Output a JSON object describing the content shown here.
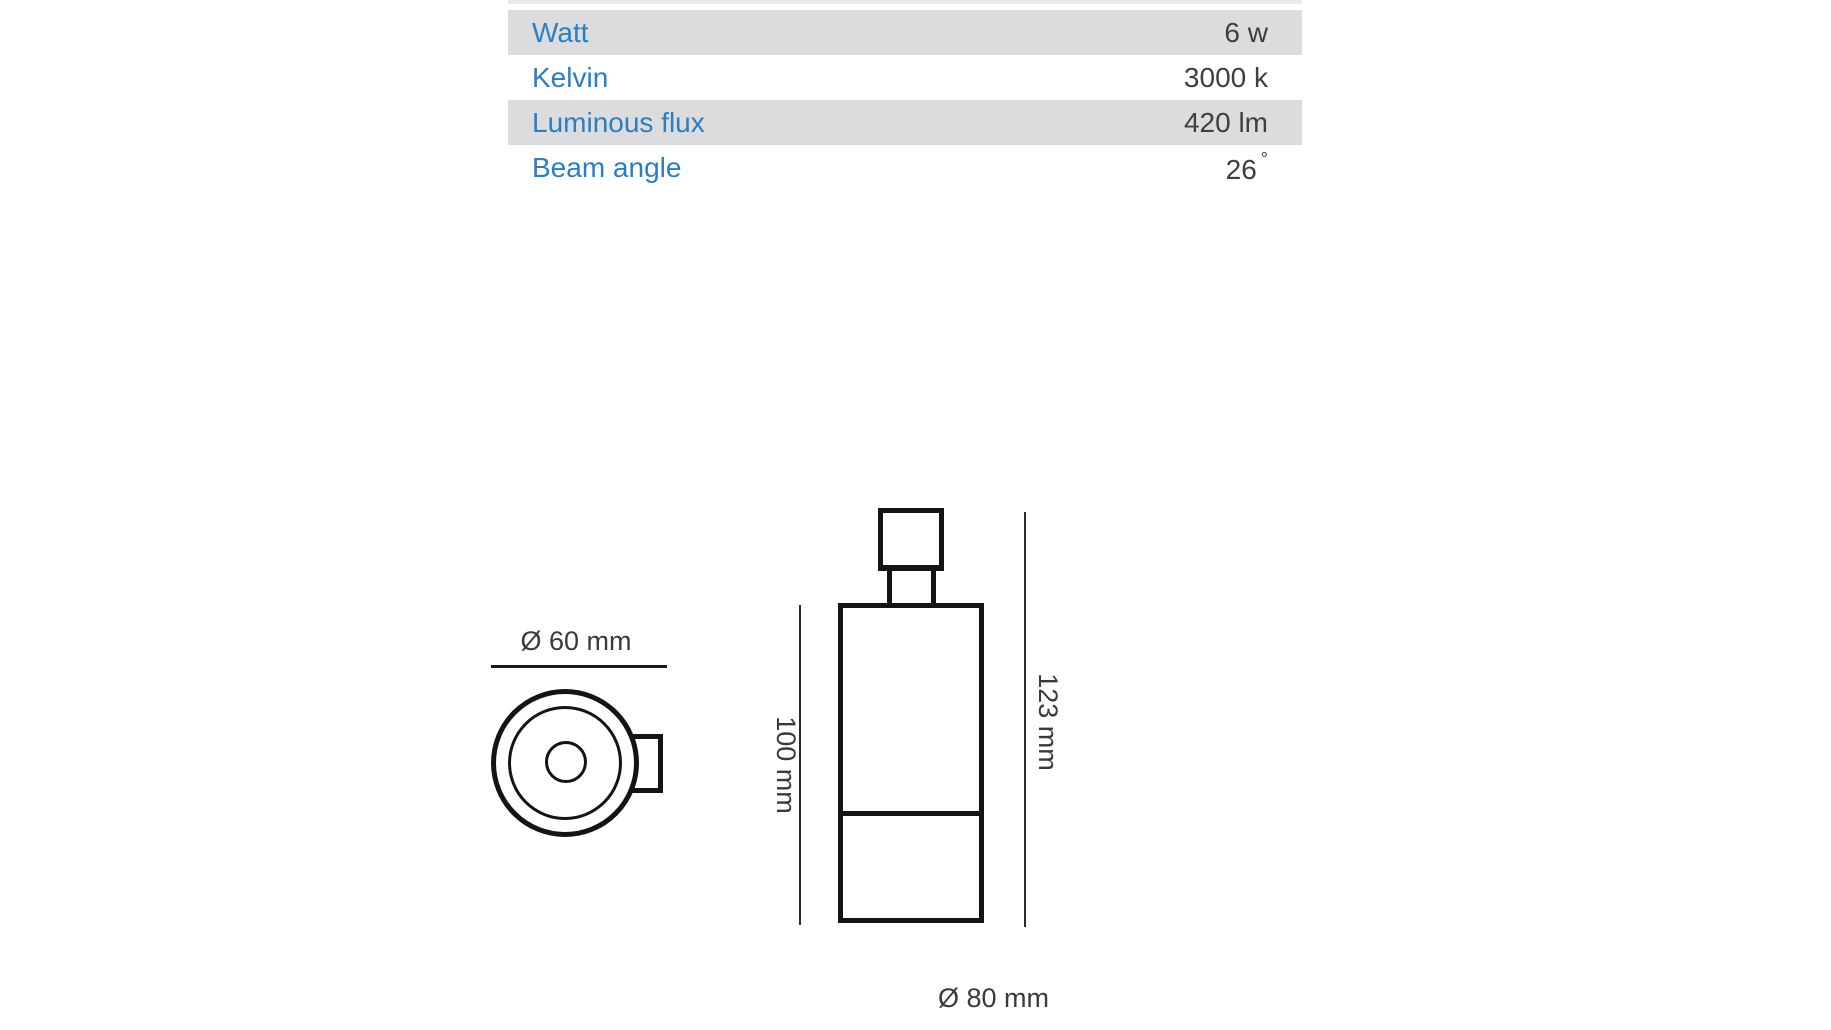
{
  "spec_table": {
    "rows": [
      {
        "label": "Watt",
        "value": "6 w"
      },
      {
        "label": "Kelvin",
        "value": "3000 k"
      },
      {
        "label": "Luminous flux",
        "value": "420 lm"
      },
      {
        "label": "Beam angle",
        "value": "26",
        "degree": "°"
      }
    ]
  },
  "drawings": {
    "top_view": {
      "diameter_label": "Ø 60 mm"
    },
    "side_view": {
      "inner_height_label": "100 mm",
      "total_height_label": "123 mm",
      "diameter_label": "Ø 80 mm"
    }
  },
  "colors": {
    "label_blue": "#2b7ec1",
    "row_gray": "#dcdcde",
    "value_text": "#3f3f3f",
    "drawing_line": "#141414"
  }
}
